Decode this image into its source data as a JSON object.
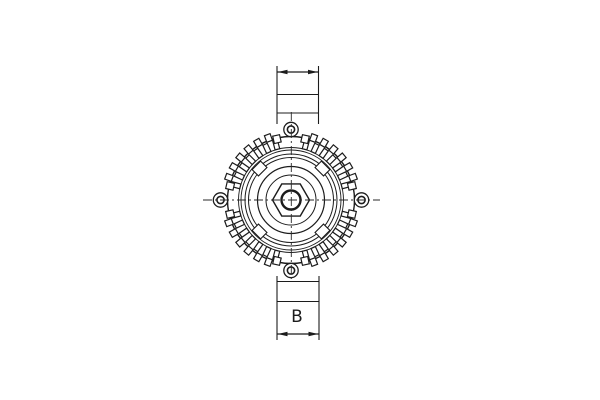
{
  "page": {
    "background": "#ffffff"
  },
  "diagram": {
    "kind": "technical-line-drawing",
    "subject": "alternator front view with dimension lines",
    "colors": {
      "line": "#1c1c1c",
      "background": "#ffffff"
    },
    "labels": {
      "bottom_dimension": "B",
      "top_dimension": ""
    }
  }
}
